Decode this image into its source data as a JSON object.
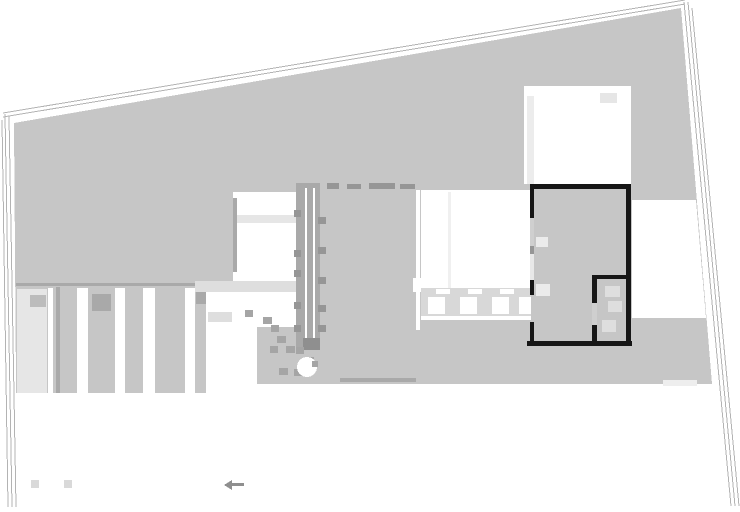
{
  "document": {
    "kind": "architectural site / floor plan drawing",
    "visible_text": ""
  },
  "colors": {
    "background": "#ffffff",
    "site_fill": "#c6c6c6",
    "boundary_line": "#b3b3b3",
    "wall_black": "#161616",
    "band_dark": "#a9a9a9",
    "band_light": "#dedede",
    "light_patch": "#e6e6e6",
    "paver_field": "#d8d8d8",
    "stone": "#a5a5a5",
    "tick": "#969696",
    "wall_light": "#cfcfcf",
    "wall_faint": "#e8e8e8",
    "fixture_faint": "#ebebeb",
    "marker_light": "#d9d9d9",
    "arrow_gray": "#8f8f8f"
  },
  "plan": {
    "elements": [
      "site-boundary-lines",
      "site-area",
      "timber-deck",
      "left-room",
      "window-band",
      "stair-band",
      "roof-ridge-dashes",
      "courtyard",
      "paver-terrace",
      "main-house-walls",
      "ensuite-partition",
      "bathroom-fixtures",
      "stepping-stones",
      "garden-circle",
      "survey-markers",
      "scale-arrow-mark"
    ]
  }
}
